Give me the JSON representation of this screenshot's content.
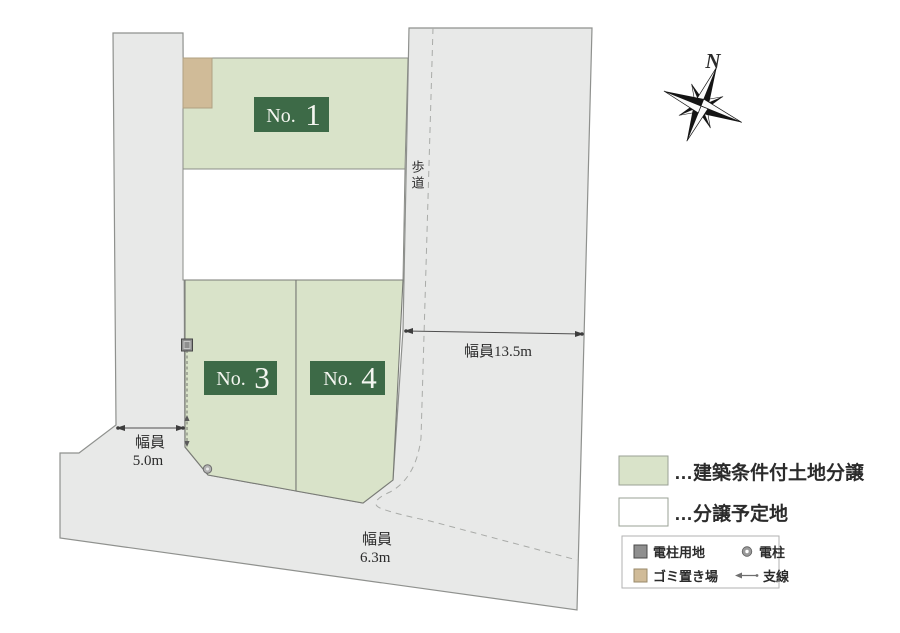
{
  "map": {
    "plots": [
      {
        "name": "plot-1",
        "prefix": "No.",
        "number": "1"
      },
      {
        "name": "plot-3",
        "prefix": "No.",
        "number": "3"
      },
      {
        "name": "plot-4",
        "prefix": "No.",
        "number": "4"
      }
    ],
    "labels": {
      "sidewalk": "歩道",
      "compass_n": "N"
    },
    "measurements": {
      "right_road": "幅員13.5m",
      "left_road_line1": "幅員",
      "left_road_line2": "5.0m",
      "bottom_road_line1": "幅員",
      "bottom_road_line2": "6.3m"
    }
  },
  "legend": {
    "building_condition": "…建築条件付土地分譲",
    "planned_lot": "…分譲予定地",
    "pole_site": "電柱用地",
    "pole": "電柱",
    "garbage": "ゴミ置き場",
    "guy_wire": "支線"
  },
  "colors": {
    "plot_green": "#d9e3c9",
    "label_green": "#3d6a47",
    "road_gray": "#e8e9e8",
    "garbage_tan": "#d0bb98",
    "lot_white": "#ffffff"
  }
}
